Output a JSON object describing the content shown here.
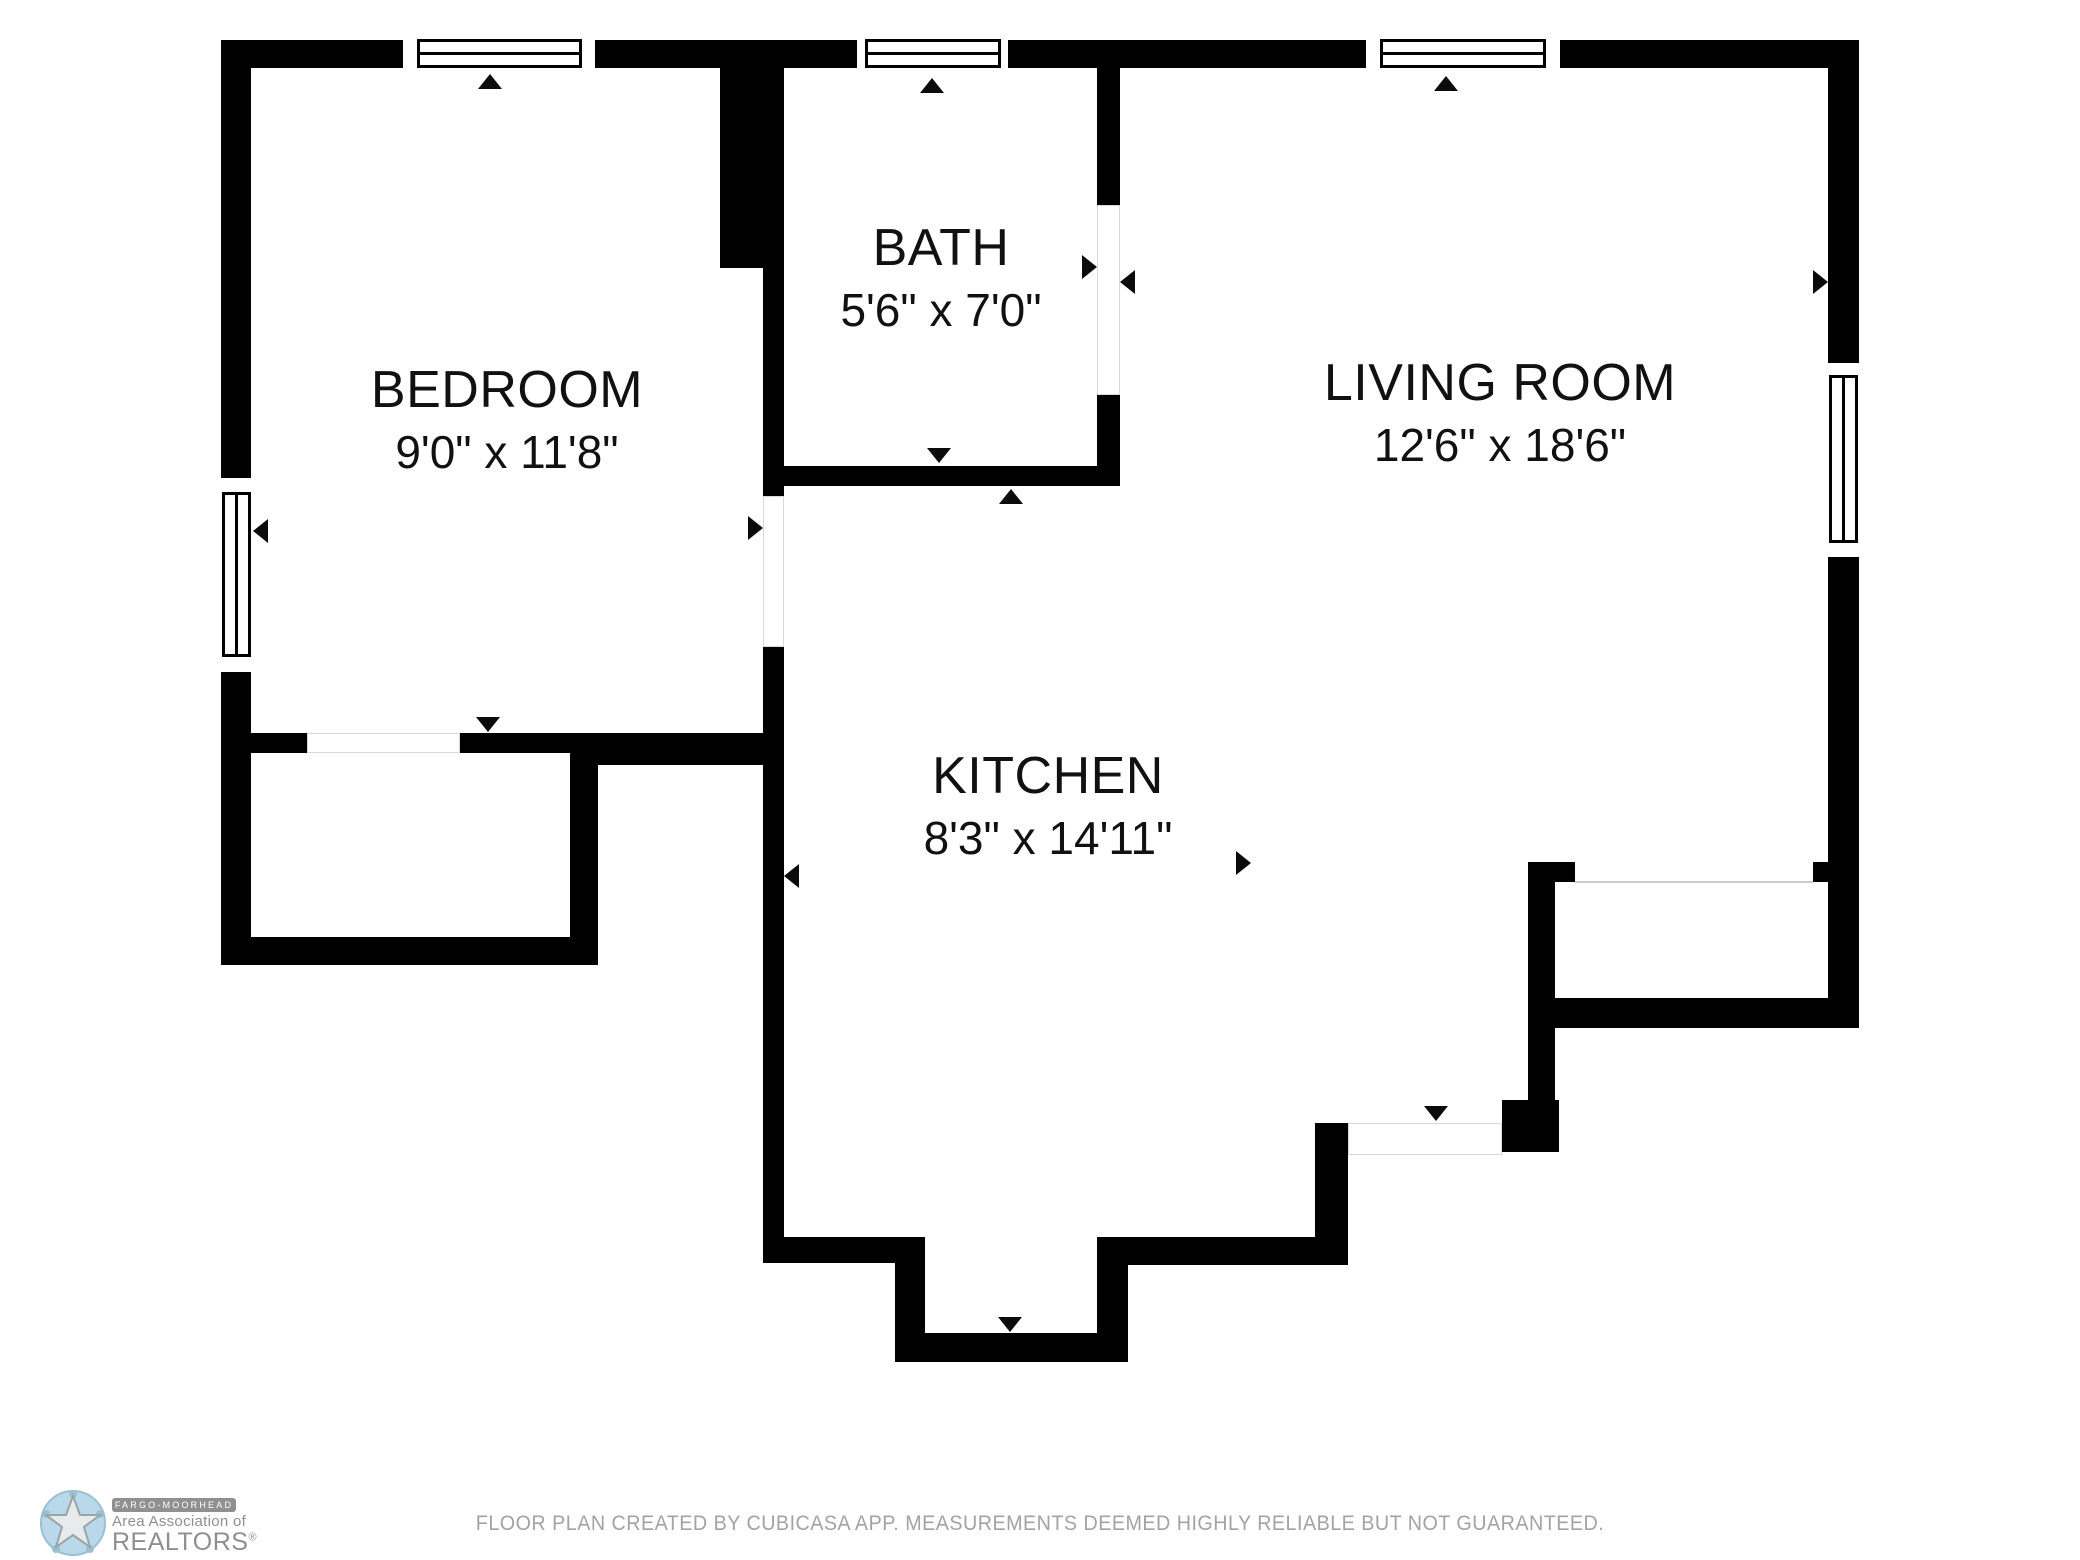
{
  "colors": {
    "wall": "#000000",
    "background": "#ffffff",
    "arrow": "#0b0b0b",
    "disclaimer_text": "#a3a3a3",
    "logo_gray": "#8f8f8f",
    "logo_blue": "#b9d8e9"
  },
  "rooms": [
    {
      "id": "bedroom",
      "name": "BEDROOM",
      "dims": "9'0\" x 11'8\""
    },
    {
      "id": "bath",
      "name": "BATH",
      "dims": "5'6\" x 7'0\""
    },
    {
      "id": "living-room",
      "name": "LIVING ROOM",
      "dims": "12'6\" x 18'6\""
    },
    {
      "id": "kitchen",
      "name": "KITCHEN",
      "dims": "8'3\" x 14'11\""
    }
  ],
  "footer": {
    "disclaimer": "FLOOR PLAN CREATED BY CUBICASA APP. MEASUREMENTS DEEMED HIGHLY RELIABLE BUT NOT GUARANTEED."
  },
  "logo": {
    "line1": "FARGO-MOORHEAD",
    "line2": "Area Association of",
    "line3": "REALTORS",
    "registered": "®"
  }
}
